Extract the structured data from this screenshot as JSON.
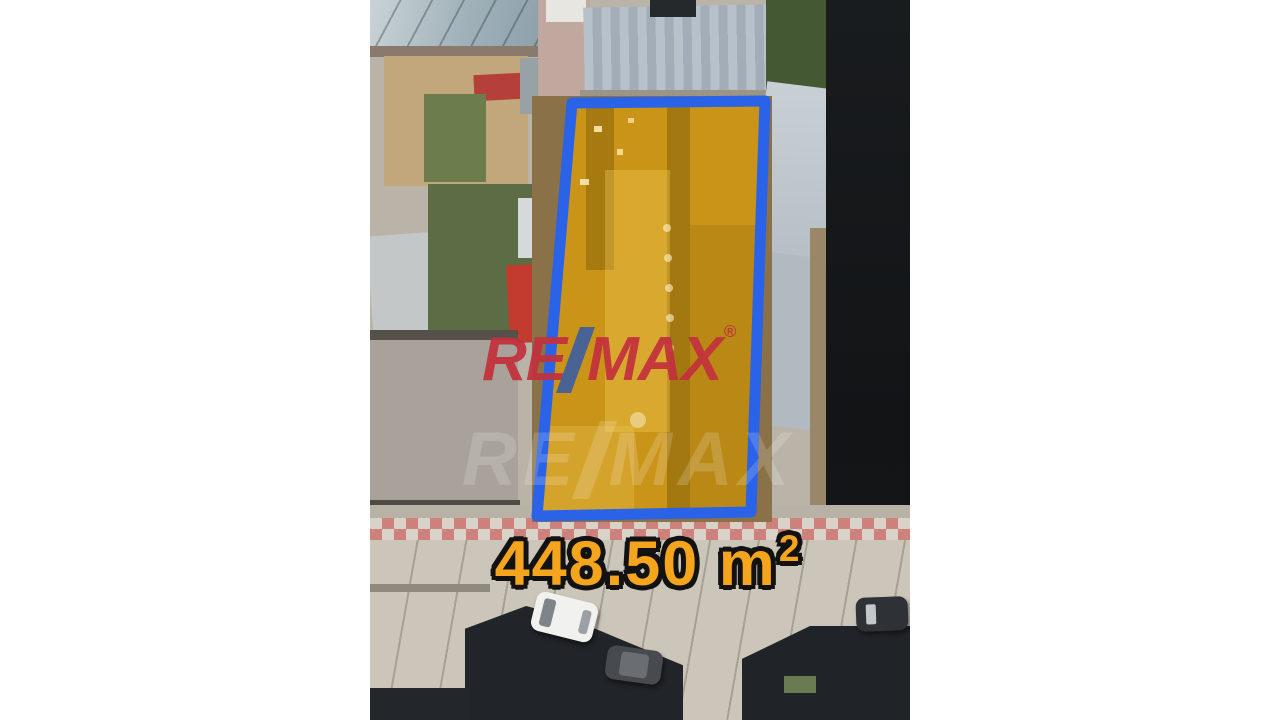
{
  "scene": {
    "type": "aerial-drone-photo",
    "subject": "real-estate lot listing photo with highlighted parcel"
  },
  "lot": {
    "area_value": "448.50 m",
    "area_exponent": "2",
    "label_color": "#F5A51D",
    "fill_color": "#D79B0F",
    "border_color": "#2A63E8"
  },
  "watermark": {
    "left": "RE",
    "right": "MAX",
    "registered": "®",
    "brand_red": "#C3313D",
    "slash_blue": "#41609F"
  },
  "watermark_faint": {
    "left": "RE",
    "right": "MAX",
    "color": "#FFFFFF"
  }
}
